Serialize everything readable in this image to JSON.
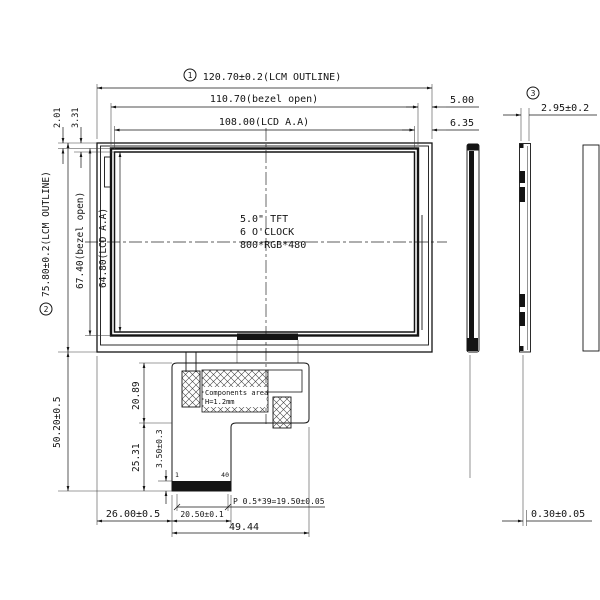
{
  "note_center": {
    "l1": "5.0\" TFT",
    "l2": "6 O'CLOCK",
    "l3": "800*RGB*480"
  },
  "refs": {
    "r1": "1",
    "r2": "2",
    "r3": "3"
  },
  "dims": {
    "lcm_w": "120.70±0.2(LCM OUTLINE)",
    "bezel_w": "110.70(bezel open)",
    "lcd_w": "108.00(LCD A.A)",
    "off_r1": "5.00",
    "off_r2": "6.35",
    "thk": "2.95±0.2",
    "off_t1": "2.01",
    "off_t2": "3.31",
    "lcm_h": "75.80±0.2(LCM OUTLINE)",
    "bezel_h": "67.40(bezel open)",
    "lcd_h": "64.80(LCD A.A)",
    "fpc_drop": "50.20±0.5",
    "fpc_seg1": "20.89",
    "fpc_seg2": "25.31",
    "contact": "3.50±0.3",
    "off_fpc": "26.00±0.5",
    "tail_w": "20.50±0.1",
    "fpc_w": "49.44",
    "pitch": "P 0.5*39=19.50±0.05",
    "tape": "0.30±0.05"
  },
  "fpc_notes": {
    "area": "Components area",
    "height": "H=1.2mm",
    "pin1": "1",
    "pin40": "40"
  }
}
